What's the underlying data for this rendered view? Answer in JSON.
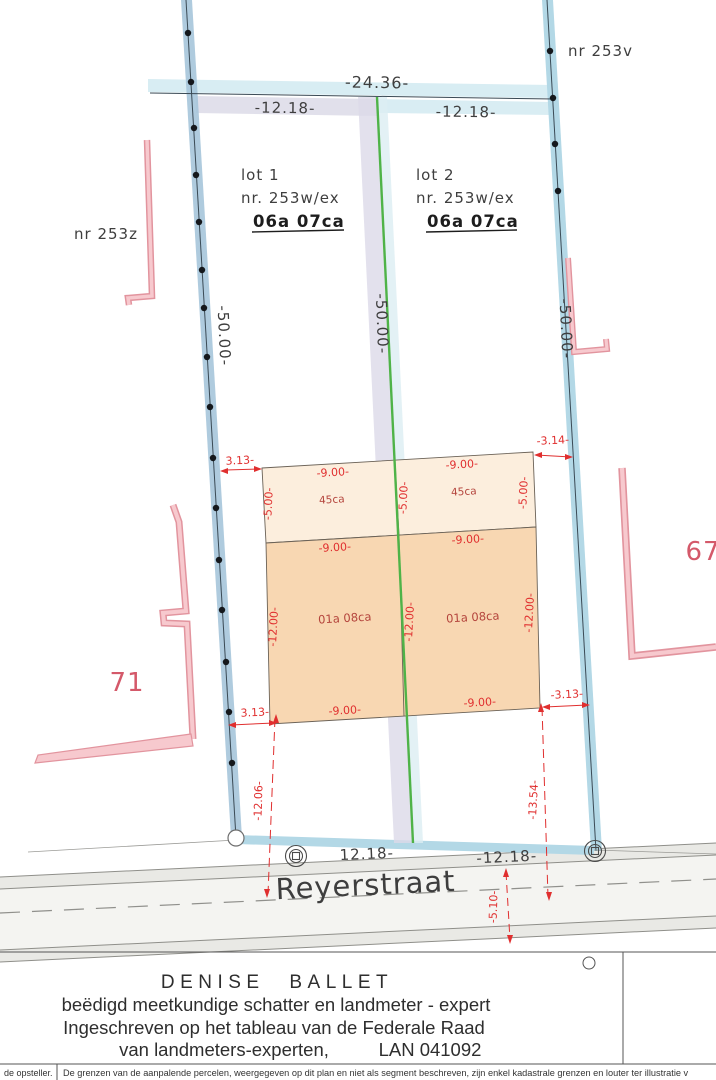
{
  "plan": {
    "labels": {
      "neighbor_top_right": "nr 253v",
      "neighbor_left": "nr 253z",
      "house_left": "71",
      "house_right": "67",
      "street": "Reyerstraat"
    },
    "lot1": {
      "title": "lot 1",
      "parcel": "nr. 253w/ex",
      "area": "06a 07ca"
    },
    "lot2": {
      "title": "lot 2",
      "parcel": "nr. 253w/ex",
      "area": "06a 07ca"
    },
    "dims": {
      "rear_total": "-24.36-",
      "rear_left": "-12.18-",
      "rear_right": "-12.18-",
      "depth_left": "-50.00-",
      "depth_mid": "-50.00-",
      "depth_right": "-50.00-",
      "front_left": "12.18-",
      "front_right": "-12.18-"
    },
    "red_dims": {
      "tl": "3.13-",
      "tr": "-3.14-",
      "bl": "3.13-",
      "br": "-3.13-",
      "w_top_l": "-9.00-",
      "w_top_r": "-9.00-",
      "w_mid_l": "-9.00-",
      "w_mid_r": "-9.00-",
      "w_bot_l": "-9.00-",
      "w_bot_r": "-9.00-",
      "h_top_l": "-5.00-",
      "h_top_m": "-5.00-",
      "h_top_r": "-5.00-",
      "h_bot_l": "-12.00-",
      "h_bot_m": "-12.00-",
      "h_bot_r": "-12.00-",
      "front_l": "-12.06-",
      "front_r": "-13.54-",
      "street_half": "-5.10-"
    },
    "areas": {
      "top_l": "45ca",
      "top_r": "45ca",
      "bot_l": "01a 08ca",
      "bot_r": "01a 08ca"
    }
  },
  "footer": {
    "name": "DENISE BALLET",
    "line2": "beëdigd meetkundige schatter en landmeter - expert",
    "line3": "Ingeschreven op het tableau van de Federale Raad",
    "line4a": "van landmeters-experten,",
    "line4b": "LAN 041092"
  },
  "strip": {
    "left": "de opsteller.",
    "right": "De grenzen van de aanpalende percelen, weergegeven op dit plan en niet als segment beschreven, zijn enkel kadastrale grenzen en louter ter illustratie v"
  },
  "colors": {
    "boundary_band_left": "#a6c5da",
    "boundary_band_right": "#b3d8e6",
    "rear_band": "#d8edf3",
    "divider_band": "#dcdae8",
    "lot_line_green": "#4fb348",
    "building_top_fill": "#fceedd",
    "building_bottom_fill": "#f8d7b2",
    "dimension_red": "#e02f2f",
    "neighbor_pink": "#efa3ac"
  }
}
